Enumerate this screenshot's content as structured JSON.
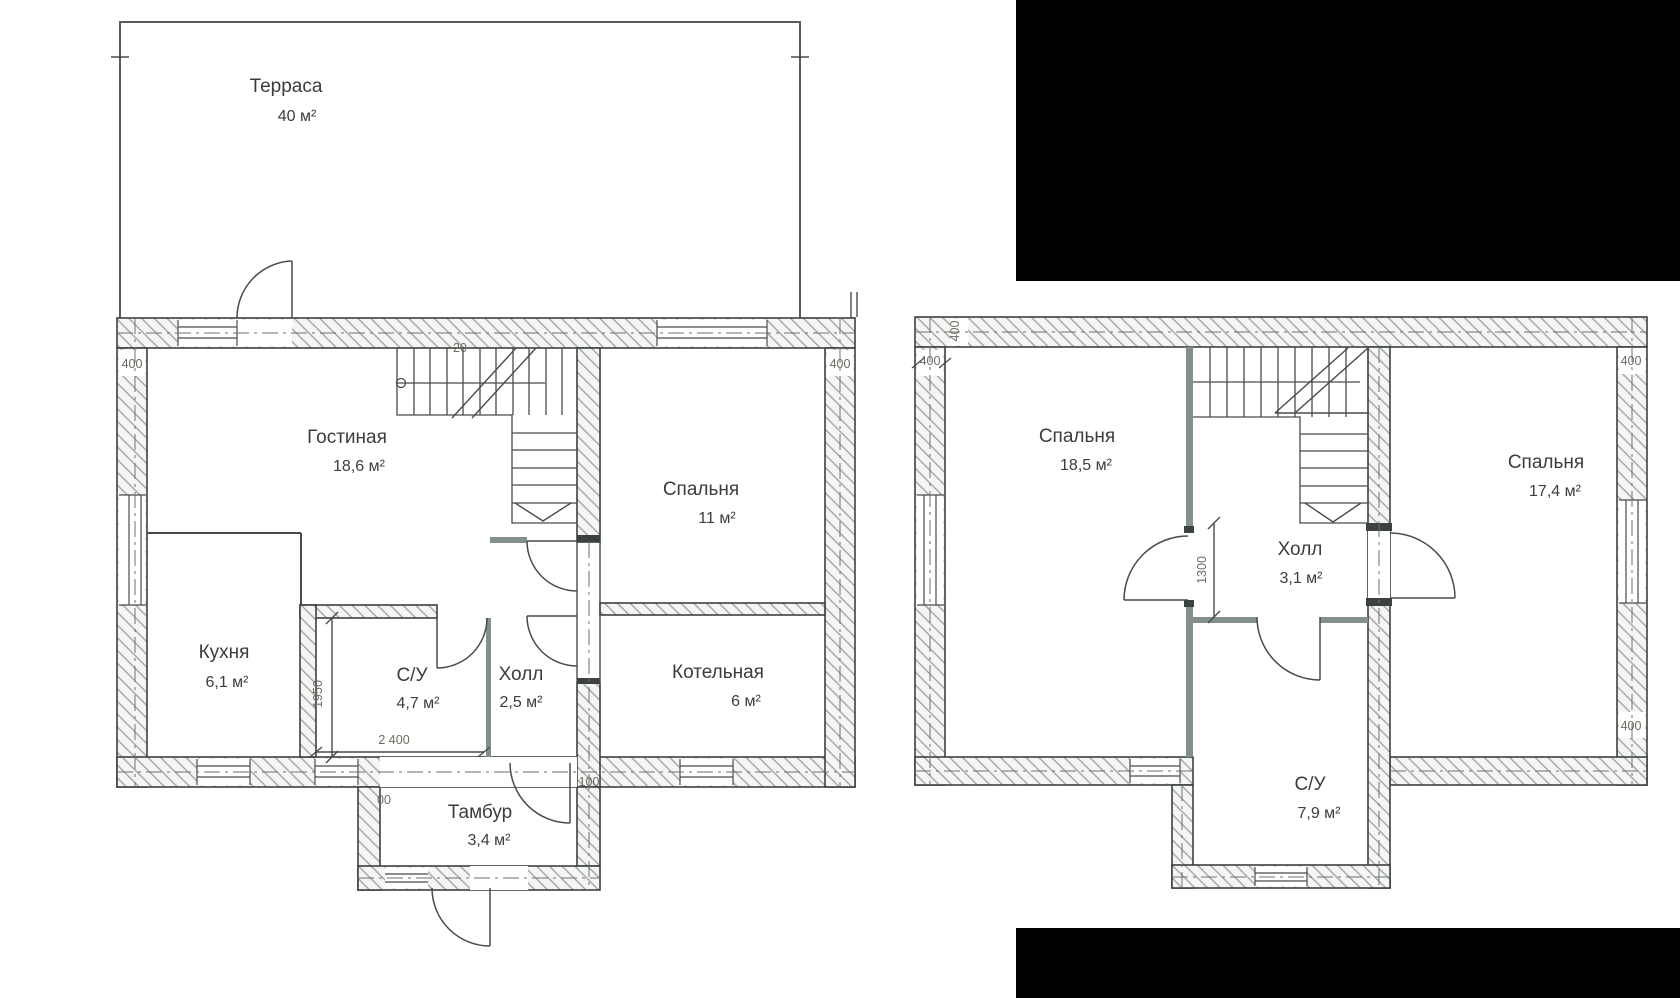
{
  "palette": {
    "background": "#ffffff",
    "wall_outline": "#3c4240",
    "hatch_line": "#9aa19f",
    "solid_partition": "#82908e",
    "line_work": "#474c4a",
    "room_text": "#393e3c",
    "dimension_text": "#6e6a5f",
    "redaction_block": "#000000"
  },
  "redactions": [
    {
      "position": "top-right"
    },
    {
      "position": "bottom-right"
    }
  ],
  "floors": [
    {
      "name": "first-floor",
      "rooms": [
        {
          "key": "terrace",
          "name": "Терраса",
          "area": "40 м²"
        },
        {
          "key": "living",
          "name": "Гостиная",
          "area": "18,6 м²"
        },
        {
          "key": "bedroom",
          "name": "Спальня",
          "area": "11 м²"
        },
        {
          "key": "kitchen",
          "name": "Кухня",
          "area": "6,1 м²"
        },
        {
          "key": "wc",
          "name": "С/У",
          "area": "4,7 м²"
        },
        {
          "key": "hall",
          "name": "Холл",
          "area": "2,5 м²"
        },
        {
          "key": "boiler",
          "name": "Котельная",
          "area": "6 м²"
        },
        {
          "key": "vestibule",
          "name": "Тамбур",
          "area": "3,4 м²"
        }
      ],
      "dimensions": [
        "400",
        "400",
        "1950",
        "2 400",
        "100",
        "00",
        "20"
      ]
    },
    {
      "name": "second-floor",
      "rooms": [
        {
          "key": "bedroom1",
          "name": "Спальня",
          "area": "18,5 м²"
        },
        {
          "key": "hall",
          "name": "Холл",
          "area": "3,1 м²"
        },
        {
          "key": "bedroom2",
          "name": "Спальня",
          "area": "17,4 м²"
        },
        {
          "key": "wc",
          "name": "С/У",
          "area": "7,9 м²"
        }
      ],
      "dimensions": [
        "400",
        "400",
        "400",
        "400",
        "1300"
      ]
    }
  ]
}
